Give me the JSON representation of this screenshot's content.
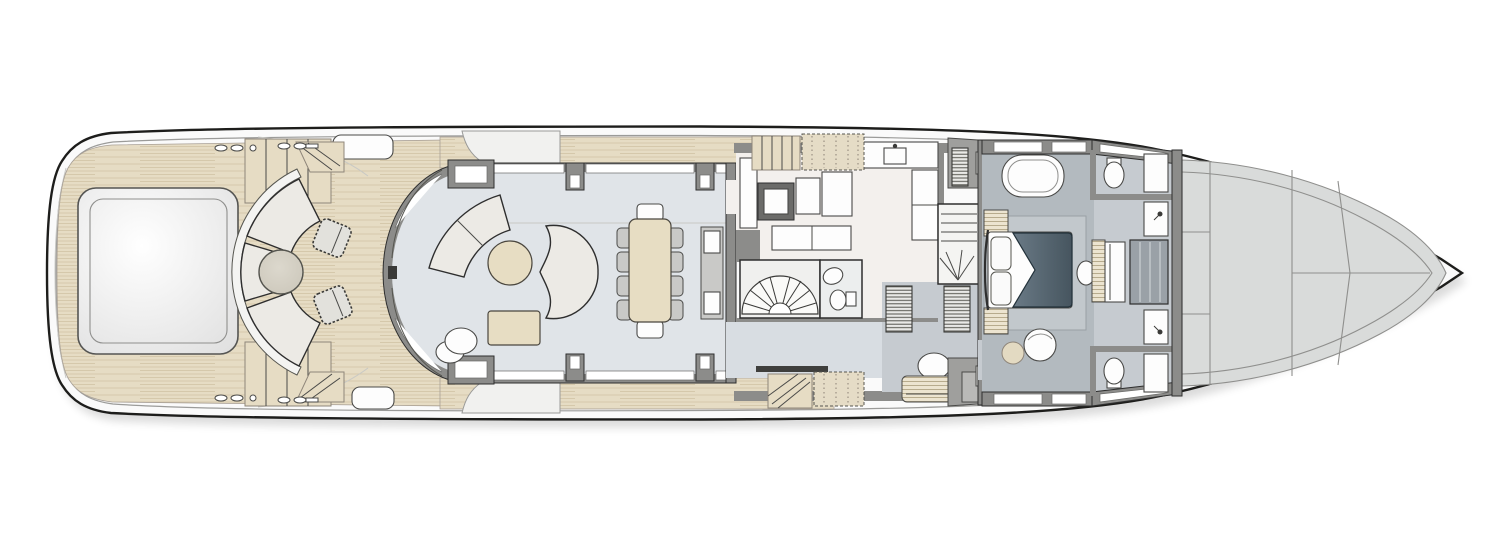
{
  "diagram": {
    "type": "yacht-deck-plan",
    "deck": "main-deck",
    "orientation": "bow-right-stern-left",
    "rooms": [
      {
        "name": "swim-platform",
        "features": [
          "transom-steps"
        ]
      },
      {
        "name": "aft-deck",
        "features": [
          "tender-hatch",
          "curved-fan-sofa",
          "round-table",
          "two-stitched-poufs",
          "side-stairs-port",
          "side-stairs-starboard",
          "deck-lockers",
          "mooring-cleats"
        ]
      },
      {
        "name": "salon",
        "features": [
          "curved-aft-glass-door",
          "crescent-sofa",
          "chevron-sofa",
          "round-cocktail-table",
          "coffee-table",
          "nesting-side-tables",
          "panoramic-windows"
        ]
      },
      {
        "name": "dining-area",
        "features": [
          "dining-table",
          "ten-chairs",
          "sideboard-console"
        ]
      },
      {
        "name": "galley",
        "features": [
          "perimeter-counters",
          "sink",
          "dumbwaiter",
          "appliance-bank",
          "island-units"
        ]
      },
      {
        "name": "foyer",
        "features": [
          "fan-staircase-down",
          "day-head-with-wc-and-sink",
          "corridor-to-master"
        ]
      },
      {
        "name": "crew-stair-lobby",
        "features": [
          "companionway-stairs",
          "wing-station-ladders",
          "boarding-steps",
          "dotted-side-pads"
        ]
      },
      {
        "name": "master-stateroom",
        "features": [
          "king-bed",
          "nightstands",
          "bathtub",
          "vanity-with-bench",
          "ottoman",
          "pouf",
          "walk-in-wardrobes",
          "rug"
        ]
      },
      {
        "name": "his-and-hers-bathrooms",
        "features": [
          "two-toilets",
          "two-sinks",
          "two-showers",
          "central-shower-unit"
        ]
      },
      {
        "name": "foredeck",
        "features": [
          "panel-seams",
          "sheer-inset-line"
        ]
      }
    ],
    "colors": {
      "teak_deck": "#e6dcc4",
      "hull_white": "#fafafa",
      "superstructure_wall": "#8c8c8a",
      "salon_floor": "#e0e4e8",
      "galley_floor": "#f3f0ed",
      "corridor_floor": "#d8dde2",
      "master_floor": "#b3babf",
      "bathroom_floor": "#c6cbd0",
      "foredeck_panel": "#d9dbda",
      "furniture_light": "#eceae5",
      "wood_furniture": "#e7ddc3",
      "bed_duvet": "#46555f",
      "outline": "#1d1d1b"
    }
  }
}
